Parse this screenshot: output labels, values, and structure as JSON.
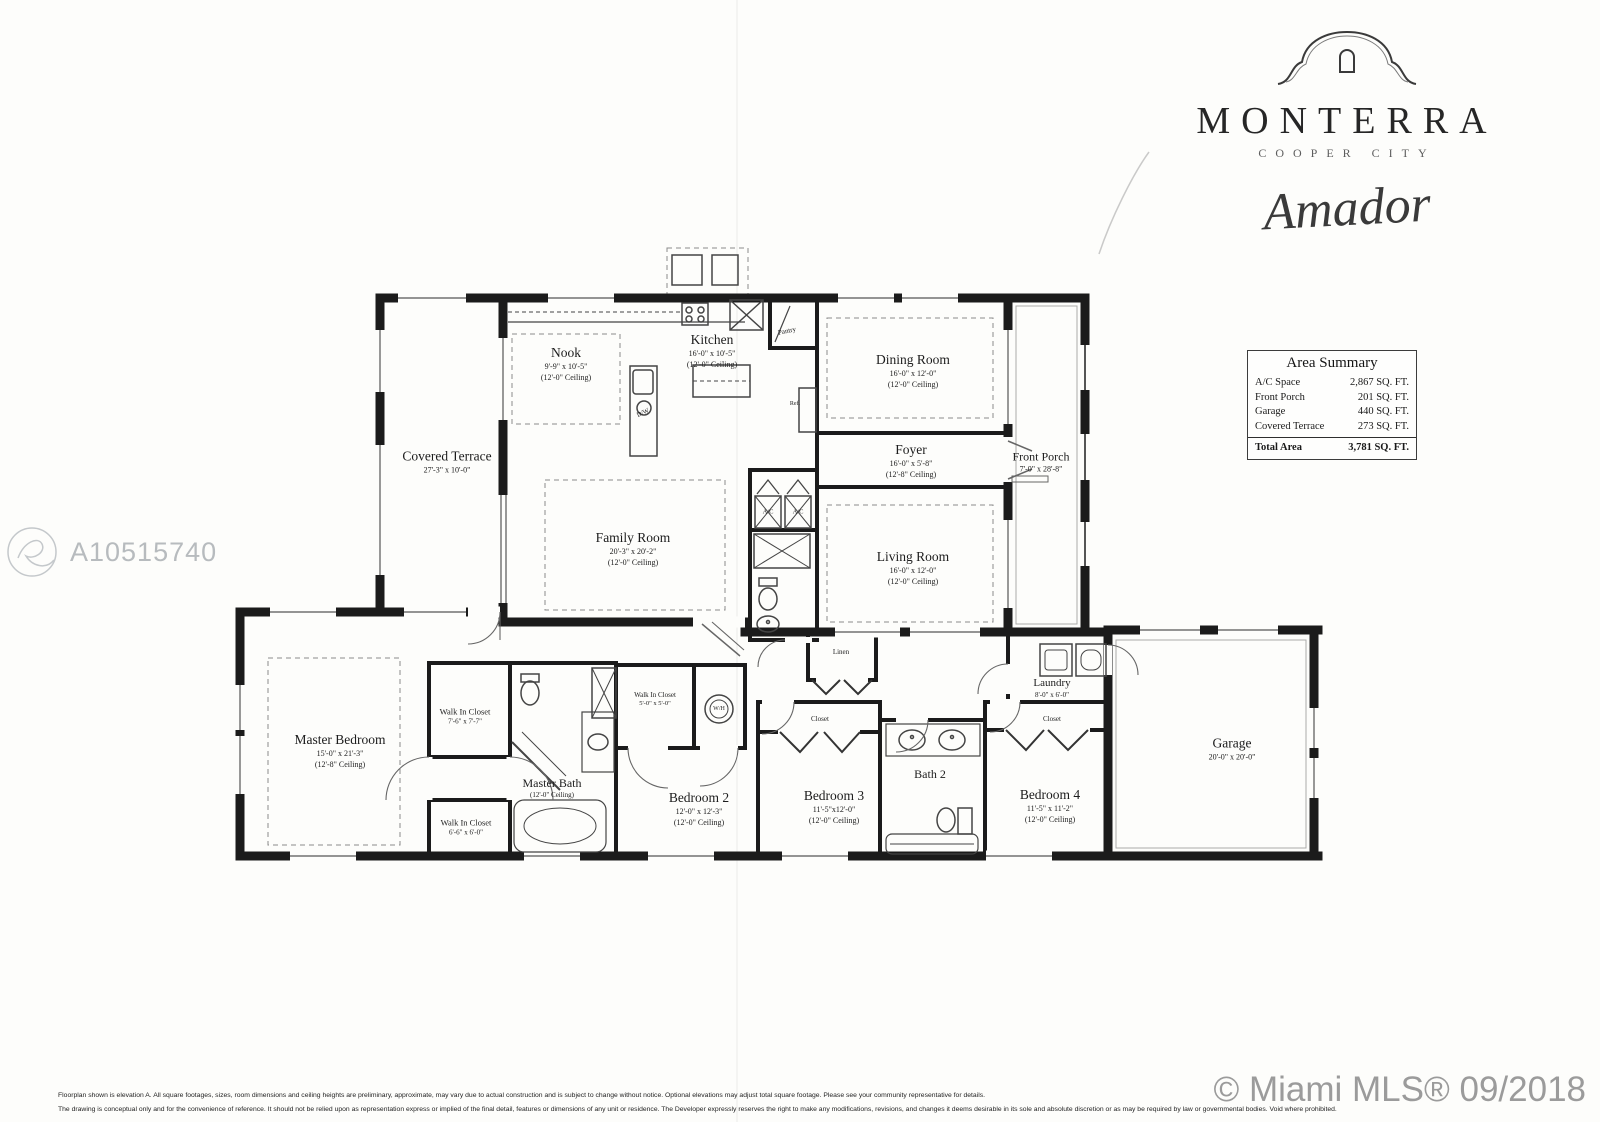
{
  "branding": {
    "community": "MONTERRA",
    "location": "COOPER CITY",
    "model": "Amador"
  },
  "watermark": {
    "id": "A10515740"
  },
  "area_summary": {
    "title": "Area Summary",
    "rows": [
      {
        "label": "A/C Space",
        "value": "2,867 SQ. FT."
      },
      {
        "label": "Front Porch",
        "value": "201 SQ. FT."
      },
      {
        "label": "Garage",
        "value": "440 SQ. FT."
      },
      {
        "label": "Covered Terrace",
        "value": "273 SQ. FT."
      }
    ],
    "total": {
      "label": "Total Area",
      "value": "3,781 SQ. FT."
    }
  },
  "rooms": [
    {
      "name": "Nook",
      "dims": "9'-9\" x 10'-5\"",
      "ceiling": "(12'-0\" Ceiling)"
    },
    {
      "name": "Kitchen",
      "dims": "16'-0\" x 10'-5\"",
      "ceiling": "(12'-0\" Ceiling)"
    },
    {
      "name": "Dining Room",
      "dims": "16'-0\" x 12'-0\"",
      "ceiling": "(12'-0\" Ceiling)"
    },
    {
      "name": "Covered Terrace",
      "dims": "27'-3\" x 10'-0\"",
      "ceiling": ""
    },
    {
      "name": "Family Room",
      "dims": "20'-3\" x 20'-2\"",
      "ceiling": "(12'-0\" Ceiling)"
    },
    {
      "name": "Foyer",
      "dims": "16'-0\" x 5'-8\"",
      "ceiling": "(12'-8\" Ceiling)"
    },
    {
      "name": "Front Porch",
      "dims": "7'-0\" x 28'-8\"",
      "ceiling": ""
    },
    {
      "name": "Living Room",
      "dims": "16'-0\" x 12'-0\"",
      "ceiling": "(12'-0\" Ceiling)"
    },
    {
      "name": "Master Bedroom",
      "dims": "15'-0\" x 21'-3\"",
      "ceiling": "(12'-8\" Ceiling)"
    },
    {
      "name": "Walk In Closet",
      "dims": "7'-6\" x 7'-7\"",
      "ceiling": ""
    },
    {
      "name": "Walk In Closet",
      "dims": "6'-6\" x 6'-0\"",
      "ceiling": ""
    },
    {
      "name": "Master Bath",
      "dims": "",
      "ceiling": "(12'-0\" Ceiling)"
    },
    {
      "name": "Walk In Closet",
      "dims": "5'-0\" x 5'-0\"",
      "ceiling": ""
    },
    {
      "name": "Bedroom 2",
      "dims": "12'-0\" x 12'-3\"",
      "ceiling": "(12'-0\" Ceiling)"
    },
    {
      "name": "Bedroom 3",
      "dims": "11'-5\"x12'-0\"",
      "ceiling": "(12'-0\" Ceiling)"
    },
    {
      "name": "Bath 2",
      "dims": "",
      "ceiling": ""
    },
    {
      "name": "Bedroom 4",
      "dims": "11'-5\" x 11'-2\"",
      "ceiling": "(12'-0\" Ceiling)"
    },
    {
      "name": "Laundry",
      "dims": "8'-0\" x 6'-0\"",
      "ceiling": ""
    },
    {
      "name": "Garage",
      "dims": "20'-0\" x 20'-0\"",
      "ceiling": ""
    }
  ],
  "fixtures": [
    {
      "text": "Pantry"
    },
    {
      "text": "Ref."
    },
    {
      "text": "D/W"
    },
    {
      "text": "A/C"
    },
    {
      "text": "A/C"
    },
    {
      "text": "Linen"
    },
    {
      "text": "W/H"
    },
    {
      "text": "Closet"
    },
    {
      "text": "Closet"
    }
  ],
  "footer": {
    "disclaimer_line1": "Floorplan shown is elevation A. All square footages, sizes, room dimensions and ceiling heights are preliminary, approximate, may vary due to actual construction and is subject to change without notice.  Optional elevations may adjust total square footage. Please see your community representative for details.",
    "disclaimer_line2": "The drawing is conceptual only and for the convenience of reference. It should not be relied upon as representation express or implied of the final detail, features or dimensions of any unit or residence. The Developer expressly reserves the right to make any modifications, revisions, and changes it deems desirable in its sole and absolute discretion or as may be required by law or governmental bodies. Void where prohibited.",
    "credit": "© Miami MLS® 09/2018"
  }
}
